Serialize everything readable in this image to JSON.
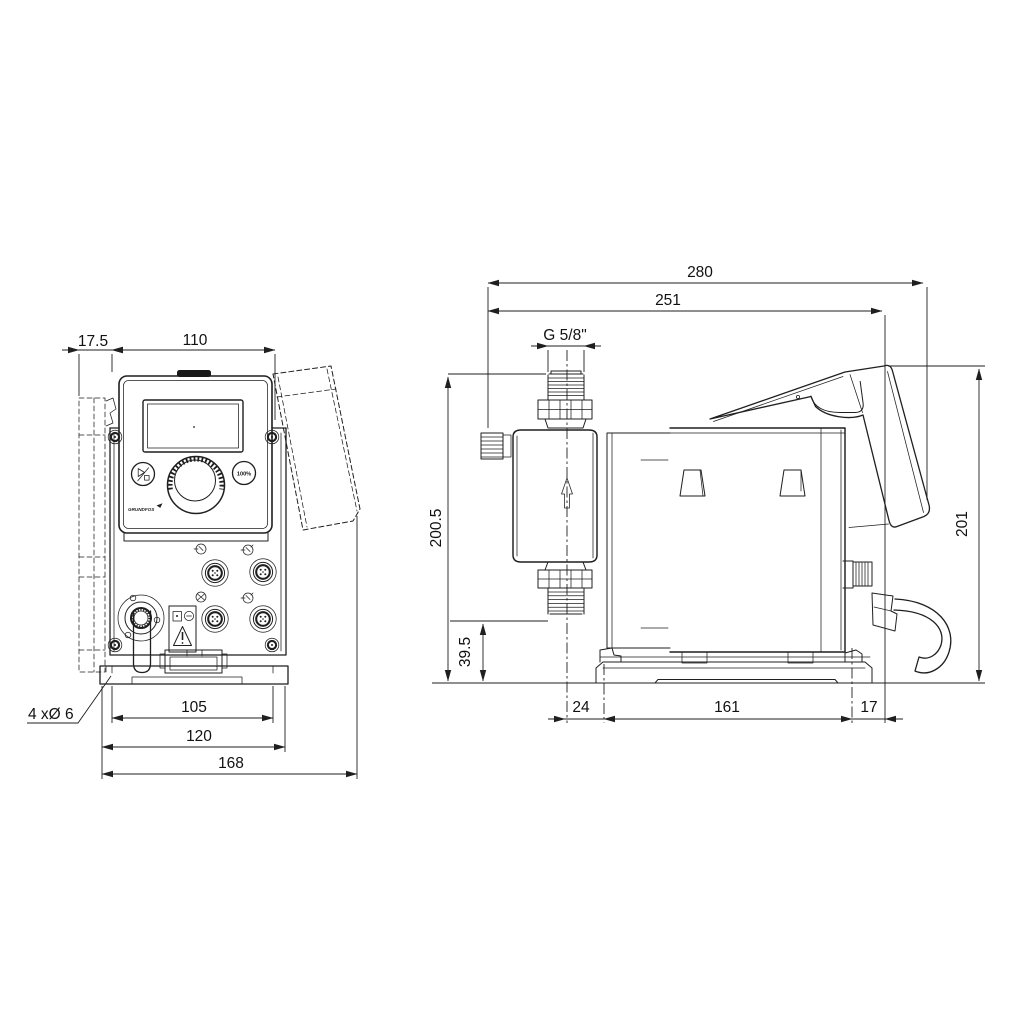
{
  "drawing": {
    "front_view": {
      "dims": {
        "wall_offset": "17.5",
        "housing_width": "110",
        "slot_spacing": "105",
        "plate_width": "120",
        "overall_width": "168"
      },
      "mounting_hole_callout": "4 xØ 6",
      "control_panel": {
        "percent_button_label": "100%",
        "brand_logo": "GRUNDFOS"
      }
    },
    "side_view": {
      "dims": {
        "overall_depth": "280",
        "depth_to_cover": "251",
        "connection_thread": "G 5/8\"",
        "overall_height": "200.5",
        "valve_to_base": "39.5",
        "centerline_to_front_slot": "24",
        "base_slot_spacing": "161",
        "rear_slot_to_edge": "17",
        "cover_height": "201"
      }
    },
    "colors": {
      "line": "#1f1f1f",
      "background": "#ffffff"
    }
  }
}
